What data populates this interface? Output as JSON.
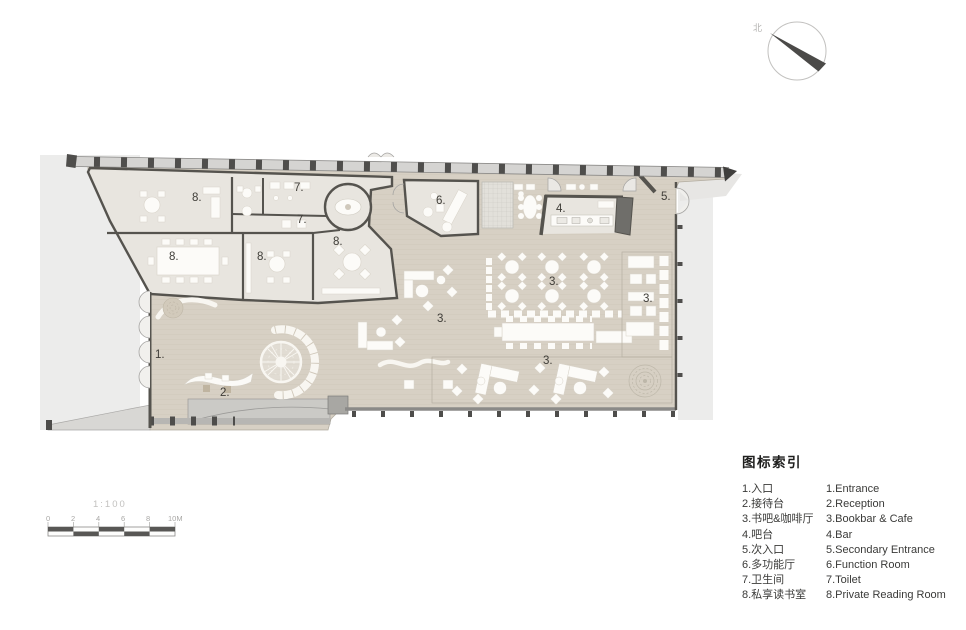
{
  "title": "floor-plan-drawing",
  "compass": {
    "north_label": "北"
  },
  "scale_bar": {
    "ratio": "1:100",
    "ticks": [
      "0",
      "2",
      "4",
      "6",
      "8",
      "10M"
    ]
  },
  "plan": {
    "room_labels": [
      "1.",
      "2.",
      "3.",
      "3.",
      "3.",
      "3.",
      "4.",
      "5.",
      "6.",
      "7.",
      "7.",
      "8.",
      "8.",
      "8.",
      "8."
    ]
  },
  "legend": {
    "title": "图标索引",
    "items": [
      {
        "zh": "1.入口",
        "en": "1.Entrance"
      },
      {
        "zh": "2.接待台",
        "en": "2.Reception"
      },
      {
        "zh": "3.书吧&咖啡厅",
        "en": "3.Bookbar & Cafe"
      },
      {
        "zh": "4.吧台",
        "en": "4.Bar"
      },
      {
        "zh": "5.次入口",
        "en": "5.Secondary Entrance"
      },
      {
        "zh": "6.多功能厅",
        "en": "6.Function Room"
      },
      {
        "zh": "7.卫生间",
        "en": "7.Toilet"
      },
      {
        "zh": "8.私享读书室",
        "en": "8.Private Reading Room"
      }
    ]
  },
  "colors": {
    "floor": "#d7d0c4",
    "room_interior": "#e8e5df",
    "wall": "#55534e",
    "exterior": "#ececeb",
    "furniture": "#fcfbf8"
  }
}
